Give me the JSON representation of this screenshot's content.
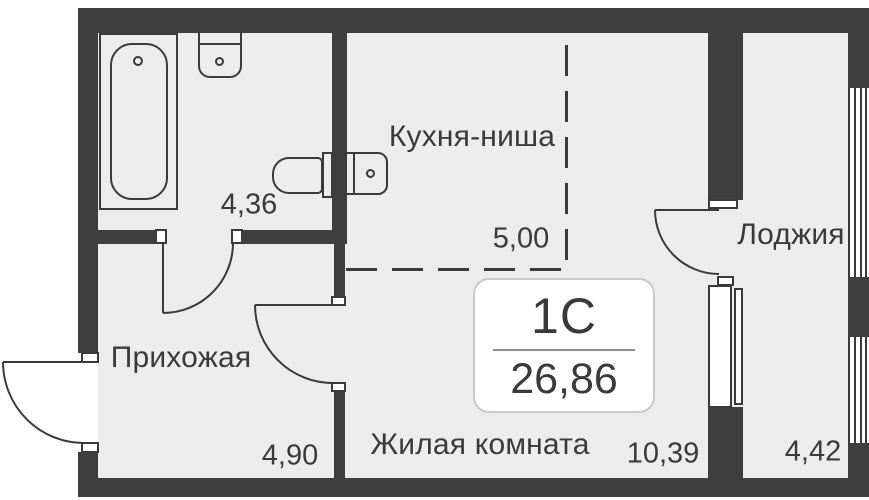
{
  "unit_badge": {
    "type": "1С",
    "total_area": "26,86"
  },
  "rooms": {
    "kitchen_niche": {
      "label": "Кухня-ниша",
      "area": "5,00"
    },
    "bathroom": {
      "area": "4,36"
    },
    "hallway": {
      "label": "Прихожая",
      "area": "4,90"
    },
    "living_room": {
      "label": "Жилая комната",
      "area": "10,39"
    },
    "loggia": {
      "label": "Лоджия",
      "area": "4,42"
    }
  },
  "colors": {
    "wall": "#3e3e3e",
    "floor": "#ececec",
    "line": "#3a3a3a",
    "text": "#3a3a3a",
    "badge_border": "#c9c9c9",
    "background": "#ffffff"
  }
}
